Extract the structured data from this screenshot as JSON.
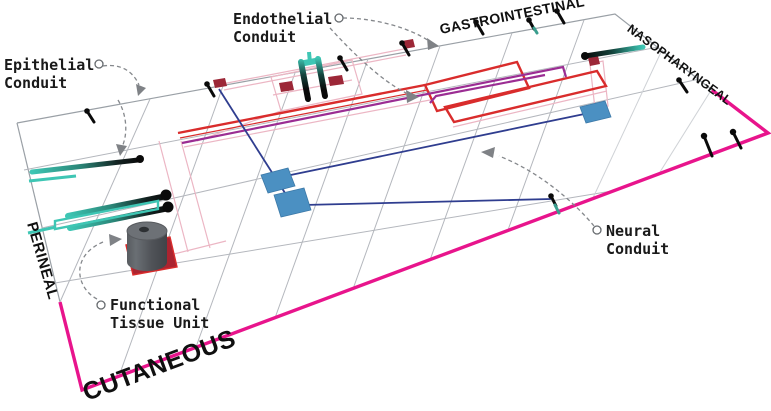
{
  "labels": {
    "epithelial": {
      "line1": "Epithelial",
      "line2": "Conduit"
    },
    "endothelial": {
      "line1": "Endothelial",
      "line2": "Conduit"
    },
    "neural": {
      "line1": "Neural",
      "line2": "Conduit"
    },
    "functional_tissue_unit": {
      "line1": "Functional",
      "line2": "Tissue Unit"
    }
  },
  "edges": {
    "top": "GASTROINTESTINAL",
    "right": "NASOPHARYNGEAL",
    "left": "PERINEAL",
    "bottom": "CUTANEOUS"
  },
  "colors": {
    "border_magenta": "#e8148c",
    "circuit_red": "#d92c2c",
    "circuit_pink": "#ecb6c4",
    "circuit_purple": "#9b2d93",
    "circuit_navy": "#2f3d8f",
    "node_blue": "#4b90c2",
    "pad_dark_red": "#9c2737",
    "conduit_teal": "#3ec6b4",
    "ink_black": "#0a0a0a",
    "annotation_gray": "#85888c"
  }
}
